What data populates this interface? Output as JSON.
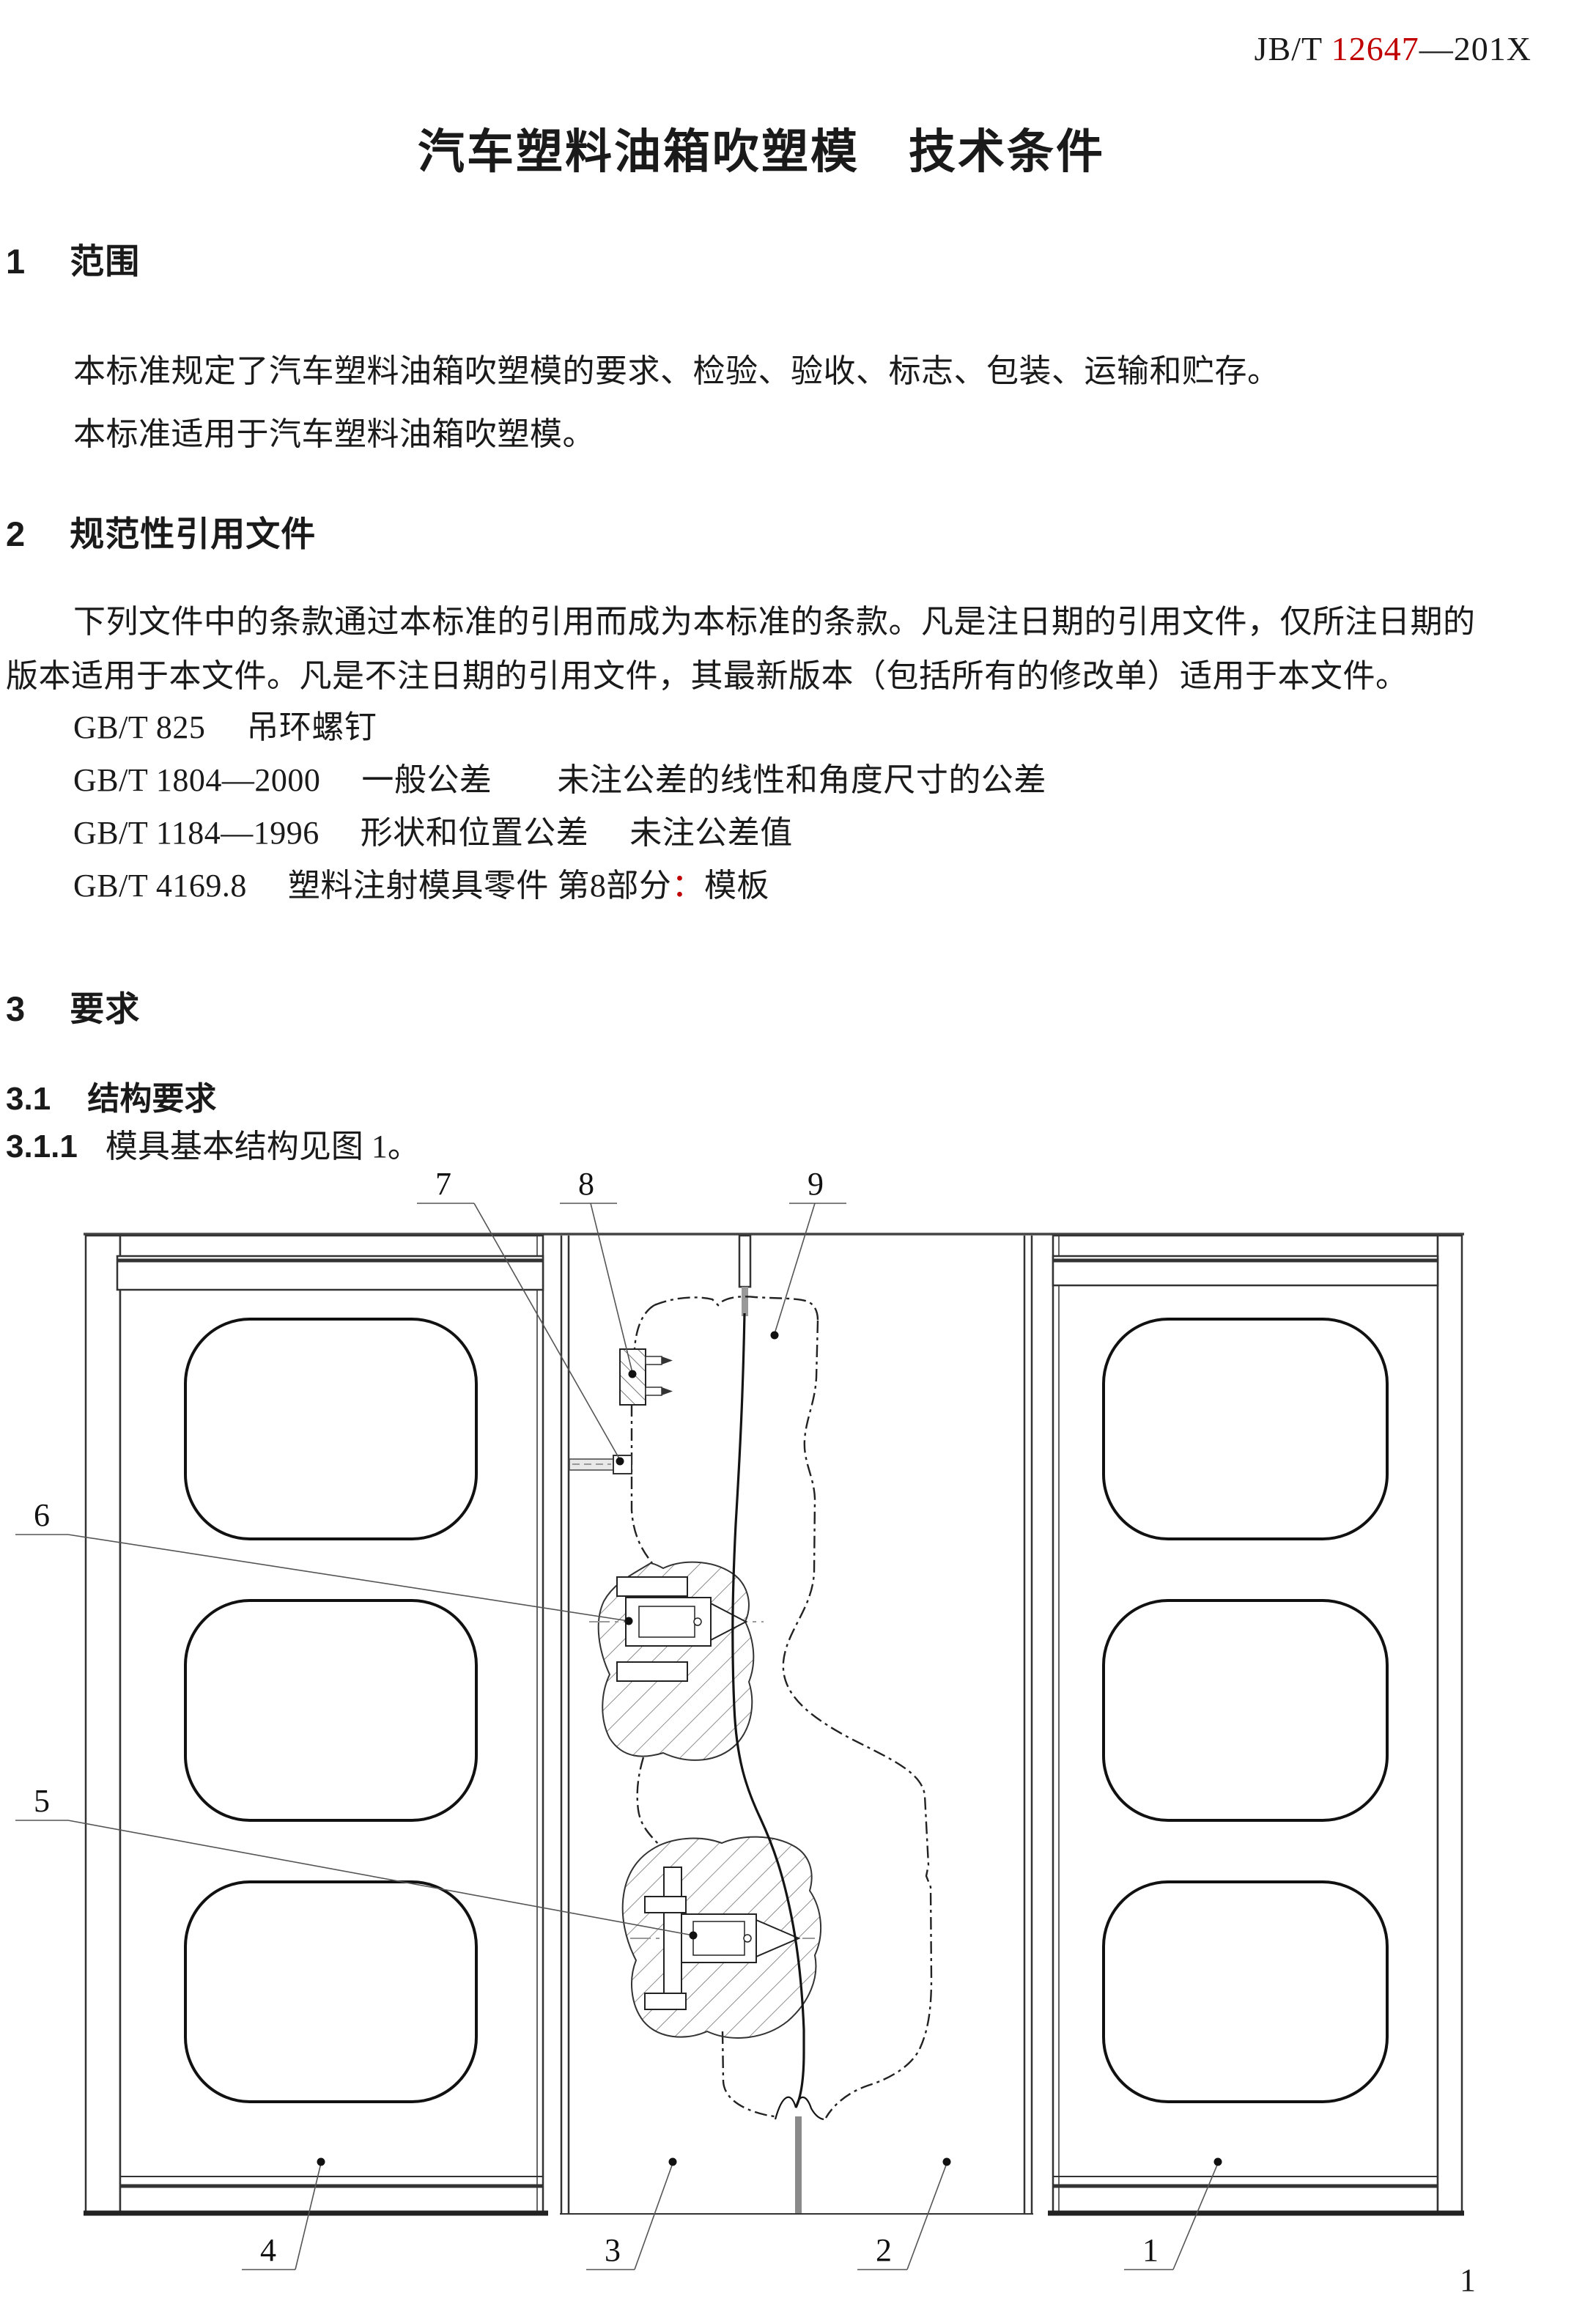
{
  "colors": {
    "accent_red": "#c00000",
    "ink": "#1a1a1a"
  },
  "header": {
    "std_prefix": "JB/T ",
    "std_number": "12647",
    "std_suffix": "—201X"
  },
  "title": "汽车塑料油箱吹塑模　技术条件",
  "s1": {
    "num": "1",
    "title": "范围"
  },
  "s1_p1": "本标准规定了汽车塑料油箱吹塑模的要求、检验、验收、标志、包装、运输和贮存。",
  "s1_p2": "本标准适用于汽车塑料油箱吹塑模。",
  "s2": {
    "num": "2",
    "title": "规范性引用文件"
  },
  "s2_p1_line1": "下列文件中的条款通过本标准的引用而成为本标准的条款。凡是注日期的引用文件，仅所注日期的",
  "s2_p1_line2": "版本适用于本文件。凡是不注日期的引用文件，其最新版本（包括所有的修改单）适用于本文件。",
  "refs": {
    "r1": "GB/T 825　 吊环螺钉",
    "r2": "GB/T 1804—2000　 一般公差　　未注公差的线性和角度尺寸的公差",
    "r3": "GB/T 1184—1996　 形状和位置公差　 未注公差值",
    "r4_pre": "GB/T 4169.8　 塑料注射模具零件 第8部分",
    "r4_colon": "：",
    "r4_post": "模板"
  },
  "s3": {
    "num": "3",
    "title": "要求"
  },
  "s31": {
    "num": "3.1",
    "title": "结构要求"
  },
  "s311": {
    "num": "3.1.1",
    "text": "模具基本结构见图 1。"
  },
  "figure": {
    "callouts": {
      "n1": "1",
      "n2": "2",
      "n3": "3",
      "n4": "4",
      "n5": "5",
      "n6": "6",
      "n7": "7",
      "n8": "8",
      "n9": "9"
    }
  },
  "page_number": "1"
}
